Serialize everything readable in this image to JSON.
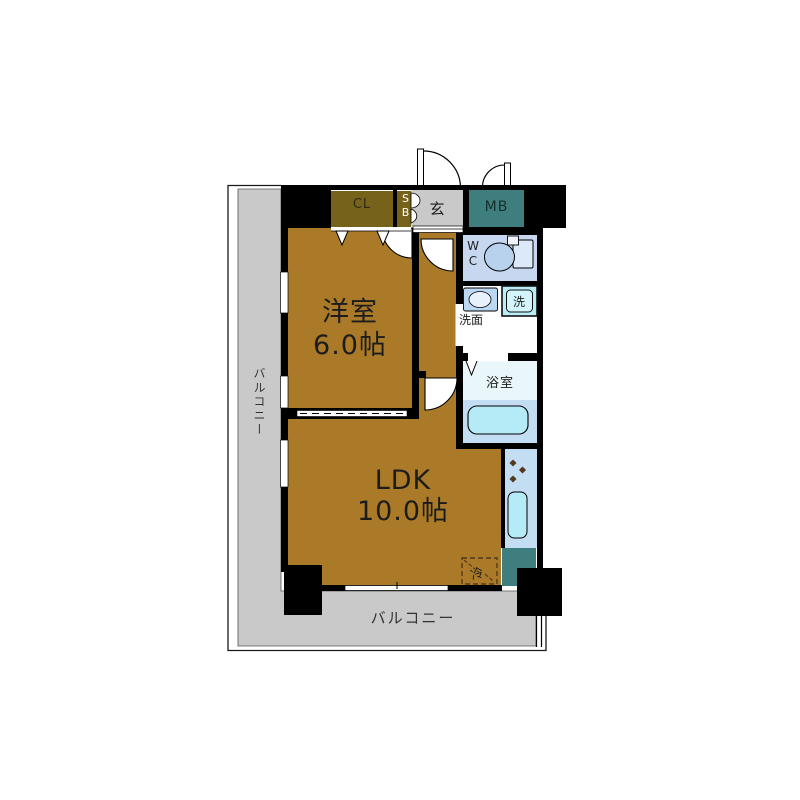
{
  "floor_plan": {
    "type": "apartment-floor-plan",
    "balcony_left_label": "バルコニー",
    "balcony_bottom_label": "バルコニー",
    "closet_label": "CL",
    "shoe_box_label": "SB",
    "entrance_label": "玄",
    "meter_box_label": "MB",
    "toilet_label": "WC",
    "washroom_label": "洗面",
    "washing_machine_label": "洗",
    "bathroom_label": "浴室",
    "refrigerator_label": "冷",
    "western_room": {
      "name": "洋室",
      "size": "6.0帖"
    },
    "ldk": {
      "name": "LDK",
      "size": "10.0帖"
    },
    "colors": {
      "floor_brown": "#ab7a28",
      "closet_olive": "#76621a",
      "meter_box_teal": "#3f7e7e",
      "balcony_gray": "#c9c9c9",
      "entrance_gray": "#c9c9c9",
      "wall_black": "#000000",
      "wc_floor_blue": "#c7d7ef",
      "bath_kitchen_blue": "#c3ddf3",
      "bath_upper_pale": "#e9f7fa",
      "fixture_cyan": "#b4ebf7",
      "burner_brown": "#52391c"
    }
  }
}
